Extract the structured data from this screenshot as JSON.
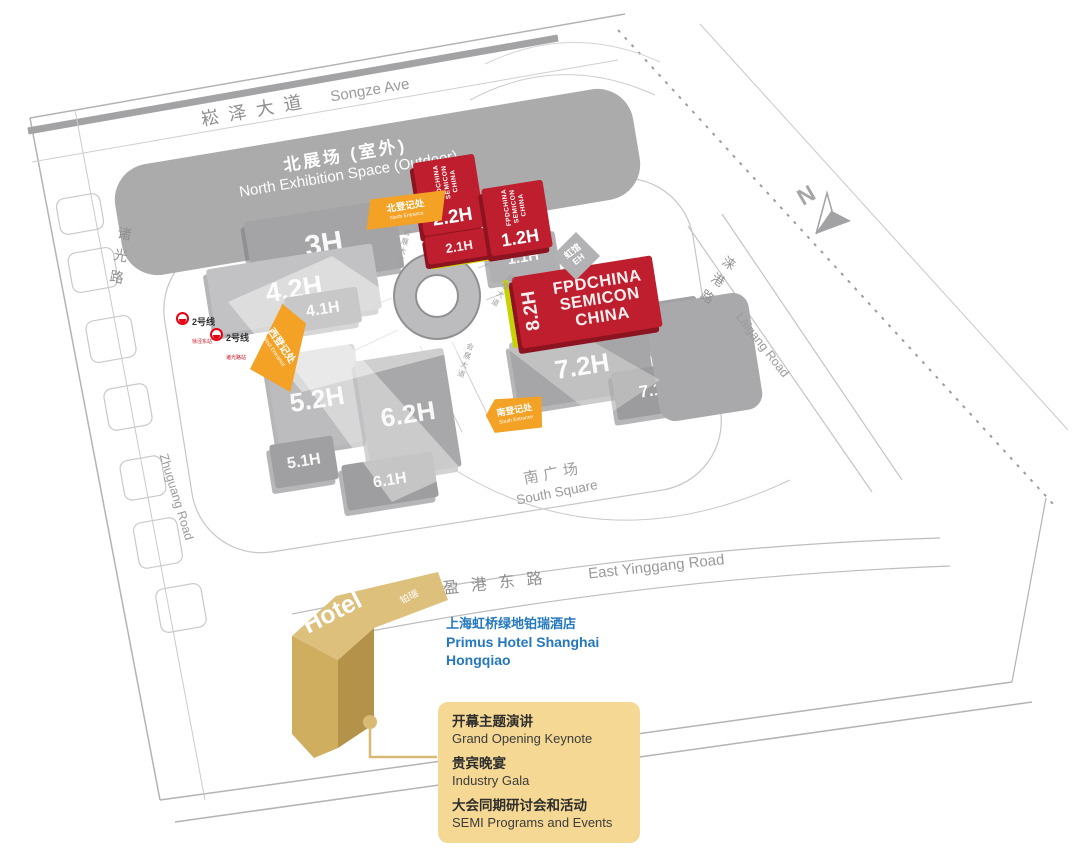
{
  "compass": {
    "label": "N"
  },
  "roads": {
    "songze": {
      "zh": "崧泽大道",
      "en": "Songze Ave"
    },
    "zhuguang": {
      "zh": "诸光路",
      "en": "Zhuguang Road"
    },
    "laigang": {
      "zh": "涞港路",
      "en": "Laigang Road"
    },
    "yinggang_east": {
      "zh": "盈港东路",
      "en": "East Yinggang Road"
    },
    "expo_avenue": {
      "zh": "会展大道"
    }
  },
  "areas": {
    "north_exhibition": {
      "zh": "北展场 (室外)",
      "en": "North Exhibition Space (Outdoor)"
    },
    "south_square": {
      "zh": "南广场",
      "en": "South Square"
    }
  },
  "halls": {
    "h3": {
      "label": "3H"
    },
    "h42": {
      "label": "4.2H"
    },
    "h41": {
      "label": "4.1H"
    },
    "h52": {
      "label": "5.2H"
    },
    "h51": {
      "label": "5.1H"
    },
    "h62": {
      "label": "6.2H"
    },
    "h61": {
      "label": "6.1H"
    },
    "h22": {
      "label": "2.2H"
    },
    "h21": {
      "label": "2.1H"
    },
    "h12": {
      "label": "1.2H"
    },
    "h11": {
      "label": "1.1H"
    },
    "h82": {
      "label": "8.2H"
    },
    "h81": {
      "label": "8.1H"
    },
    "h72": {
      "label": "7.2H"
    },
    "h71": {
      "label": "7.1H"
    },
    "eh": {
      "zh": "虹馆",
      "en": "EH"
    }
  },
  "event_banner": {
    "line1": "FPDCHINA",
    "line2": "SEMICON",
    "line3": "CHINA"
  },
  "entrances": {
    "north": {
      "zh": "北登记处",
      "en": "North Entrance"
    },
    "west": {
      "zh": "西登记处",
      "en": "West Entrance"
    },
    "south": {
      "zh": "南登记处",
      "en": "South Entrance"
    }
  },
  "metro": {
    "markers": [
      {
        "line": "2号线",
        "station": "徐泾东站"
      },
      {
        "line": "2号线",
        "station": "诸光路站"
      }
    ]
  },
  "hotel": {
    "roof_label": "Hotel",
    "roof_tag": "铂瑞",
    "name_zh": "上海虹桥绿地铂瑞酒店",
    "name_en_line1": "Primus Hotel Shanghai",
    "name_en_line2": "Hongqiao"
  },
  "legend": {
    "items": [
      {
        "zh": "开幕主题演讲",
        "en": "Grand Opening Keynote"
      },
      {
        "zh": "贵宾晚宴",
        "en": "Industry Gala"
      },
      {
        "zh": "大会同期研讨会和活动",
        "en": "SEMI Programs and Events"
      }
    ]
  },
  "colors": {
    "semi_red": "#be1e2d",
    "entrance_orange": "#f3a226",
    "stripe_green": "#c5d300",
    "hotel_gold": "#d9bc77",
    "legend_bg": "#f4d894",
    "hotel_link_blue": "#2478bd",
    "hall_gray": "#a8a8aa",
    "metro_red": "#e60012"
  }
}
